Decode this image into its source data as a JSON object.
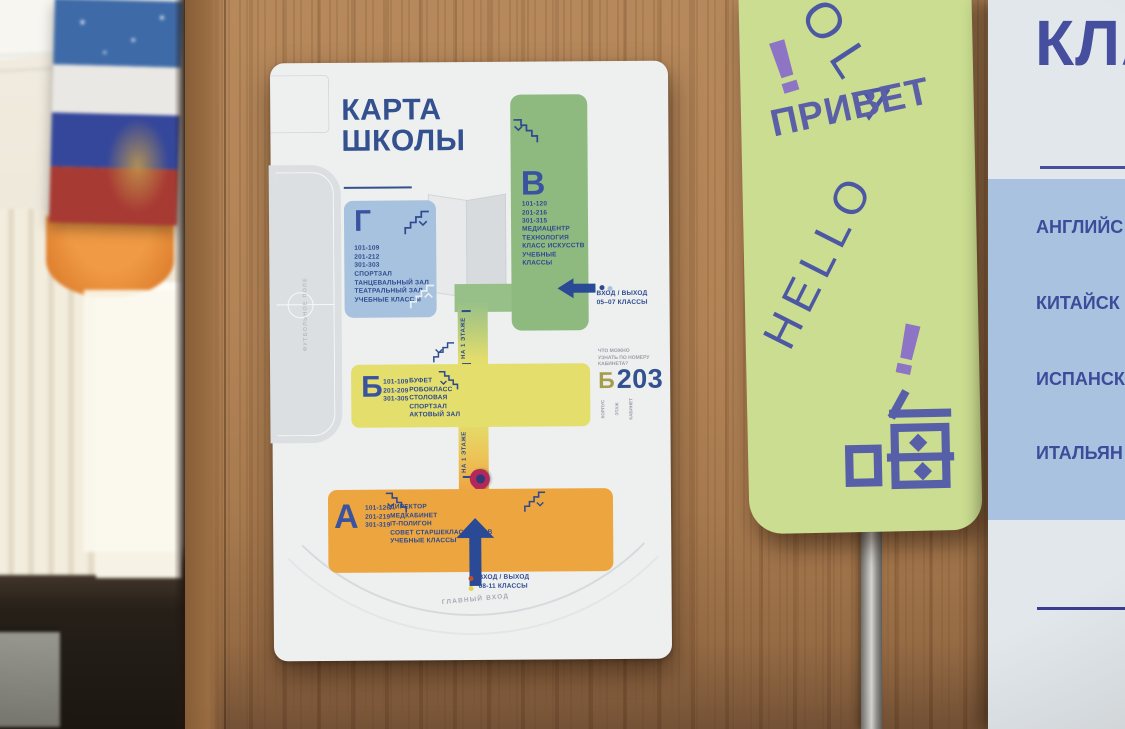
{
  "map_poster": {
    "title_lines": [
      "КАРТА",
      "ШКОЛЫ"
    ],
    "field_label": "ФУТБОЛЬНОЕ ПОЛЕ",
    "corridor_label": "НА 1 ЭТАЖЕ",
    "blocks": {
      "v": {
        "letter": "В",
        "rooms": [
          "101-120",
          "201-216",
          "301-315"
        ],
        "facilities": [
          "МЕДИАЦЕНТР",
          "ТЕХНОЛОГИЯ",
          "КЛАСС ИСКУССТВ",
          "УЧЕБНЫЕ КЛАССЫ"
        ]
      },
      "g": {
        "letter": "Г",
        "rooms": [
          "101-109",
          "201-212",
          "301-303"
        ],
        "facilities": [
          "СПОРТЗАЛ",
          "ТАНЦЕВАЛЬНЫЙ ЗАЛ",
          "ТЕАТРАЛЬНЫЙ ЗАЛ",
          "УЧЕБНЫЕ КЛАССЫ"
        ]
      },
      "b": {
        "letter": "Б",
        "rooms": [
          "101-109",
          "201-209",
          "301-305"
        ],
        "facilities": [
          "БУФЕТ",
          "РОБОКЛАСС",
          "СТОЛОВАЯ",
          "СПОРТЗАЛ",
          "АКТОВЫЙ ЗАЛ"
        ]
      },
      "a": {
        "letter": "А",
        "rooms": [
          "101-126",
          "201-219",
          "301-319"
        ],
        "facilities": [
          "ДИРЕКТОР",
          "МЕДКАБИНЕТ",
          "IT-ПОЛИГОН",
          "СОВЕТ СТАРШЕКЛАССНИКОВ",
          "УЧЕБНЫЕ КЛАССЫ"
        ]
      }
    },
    "entrance_top": [
      "ВХОД / ВЫХОД",
      "05–07 КЛАССЫ"
    ],
    "entrance_bottom": [
      "ВХОД / ВЫХОД",
      "08-11 КЛАССЫ"
    ],
    "main_entrance_label": "ГЛАВНЫЙ ВХОД",
    "room_code": {
      "hint_lines": [
        "ЧТО МОЖНО",
        "УЗНАТЬ ПО НОМЕРУ",
        "КАБИНЕТА?"
      ],
      "building": "Б",
      "number": "203",
      "part_labels": [
        "КОРПУС",
        "ЭТАЖ",
        "КАБИНЕТ"
      ]
    },
    "colors": {
      "navy": "#33508f",
      "green": "#8eba80",
      "blue": "#a6c2df",
      "yellow": "#e4de6c",
      "orange": "#eda63f",
      "pin": "#b3285a"
    }
  },
  "greeting_poster": {
    "hola_fragment": "OLA",
    "exclamation": "!",
    "privet": "ПРИВЕТ",
    "hello": "HELLO",
    "hi_chinese": "嗨",
    "colors": {
      "background": "#cadd90",
      "purple": "#8d74c4",
      "blue": "#5a5fa8"
    }
  },
  "language_poster": {
    "title_fragment": "КЛА",
    "languages": [
      "АНГЛИЙС",
      "КИТАЙСК",
      "ИСПАНСК",
      "ИТАЛЬЯН"
    ],
    "colors": {
      "background": "#e1e7eb",
      "panel": "#a9c2e0",
      "text": "#3c4b9a"
    }
  }
}
